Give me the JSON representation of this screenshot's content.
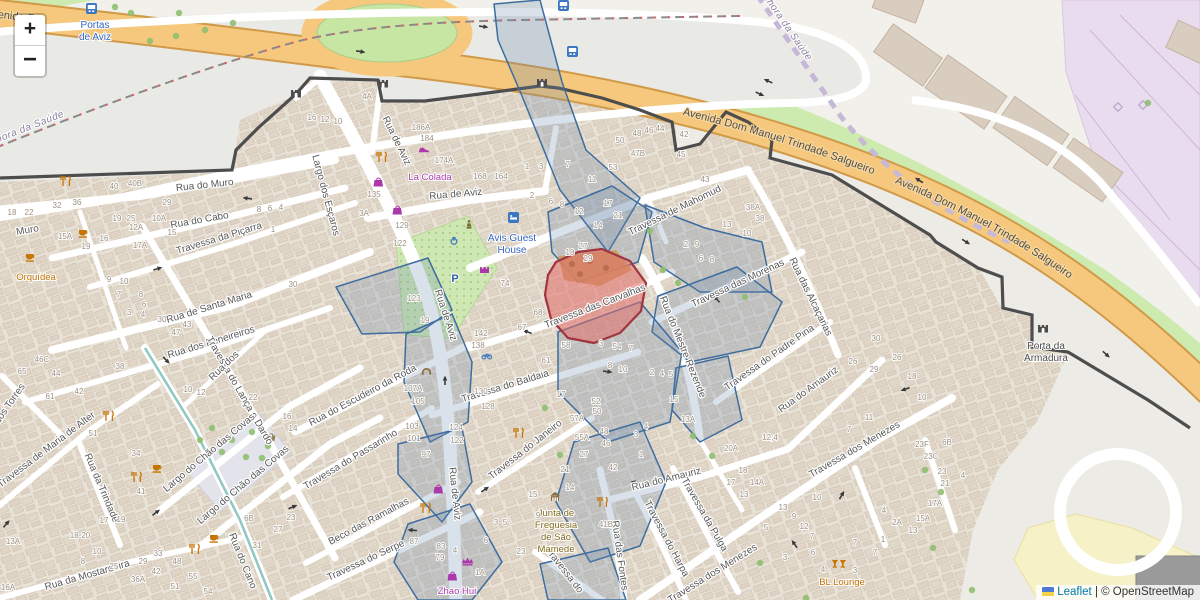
{
  "controls": {
    "zoom_in": "+",
    "zoom_out": "−"
  },
  "attribution": {
    "leaflet": "Leaflet",
    "separator": "|",
    "copyright": "© OpenStreetMap"
  },
  "avenue": {
    "name": "Avenida Dom Manuel Trindade Salgueiro"
  },
  "boundary": {
    "a": "Bacelo e Senhora da Saúde",
    "b": "Bacelo e Senhora da Saúde"
  },
  "fragments": {
    "avenida": "Avenida D"
  },
  "streets": [
    "Rua de Aviz",
    "Rua de Aviz",
    "Rua de Aviz",
    "Rua de Aviz",
    "Rua do Muro",
    "Muro",
    "Rua do Cabo",
    "Travessa da Piçarra",
    "Rua de Santa Maria",
    "Rua dos Peneireiros",
    "Largo dos Esçaros",
    "Travessa do Lança e Dardo",
    "Travessa do Baldaia",
    "Travessa do Janeiro",
    "Rua do Escudeiro da Roda",
    "Travessa do Passarinho",
    "Beco das Ramalhas",
    "Travessa do Serpe",
    "Rua da Trindade",
    "Travessa de Maria de Alter",
    "Rua dos Torres",
    "Largo do Chão das Covas",
    "Largo do Chão das Covas",
    "Rua do Cano",
    "Rua da Mostardeira",
    "Rua dos",
    "Rua do Amauriz",
    "Rua do Amauriz",
    "Travessa do Harpa",
    "Travessa da Pulga",
    "Travessa dos Menezes",
    "Travessa dos Menezes",
    "Travessa do Padre Pina",
    "Rua do Mestre Rezende",
    "Travessa das Morenas",
    "Travessa de Mahomud",
    "Rua das Alcaçarias",
    "Travessa das Carvalhas",
    "Rua das Fontes",
    "Travessa do"
  ],
  "places": {
    "portas": {
      "l1": "Portas",
      "l2": "de Aviz"
    },
    "la_colada": "La Colada",
    "avis": {
      "l1": "Avis Guest",
      "l2": "House"
    },
    "orquidea": "Orquídea",
    "junta": {
      "l1": "Junta de",
      "l2": "Freguesia",
      "l3": "de São",
      "l4": "Mamede"
    },
    "zhao": "Zhao Hui",
    "bl": "BL Lounge",
    "armadura": {
      "l1": "Porta da",
      "l2": "Armadura"
    },
    "parking": "P"
  },
  "nums": [
    "18",
    "22",
    "32",
    "36",
    "40",
    "40B",
    "29",
    "19",
    "25",
    "12A",
    "10A",
    "15",
    "17A",
    "15A",
    "19",
    "16",
    "9",
    "10",
    "7",
    "8",
    "6",
    "4",
    "3",
    "30",
    "43",
    "47",
    "8",
    "6",
    "4",
    "1",
    "30",
    "46C",
    "65",
    "44",
    "61",
    "42",
    "38",
    "51",
    "34",
    "41",
    "17",
    "19",
    "18-20",
    "13A",
    "10",
    "8",
    "25",
    "36A",
    "29",
    "33",
    "48",
    "42",
    "55",
    "51",
    "54",
    "6B",
    "23",
    "27",
    "31",
    "16",
    "14",
    "22",
    "10",
    "12",
    "16A",
    "4A",
    "16",
    "12",
    "10",
    "186A",
    "184",
    "174A",
    "168",
    "164",
    "135",
    "3A",
    "129",
    "122",
    "123",
    "19",
    "142",
    "138",
    "107A",
    "105",
    "103",
    "101",
    "97",
    "130",
    "128",
    "124",
    "122",
    "87",
    "83",
    "79",
    "1",
    "3",
    "7",
    "2",
    "6",
    "8",
    "12",
    "14",
    "17",
    "21",
    "11",
    "18",
    "27",
    "29",
    "74",
    "68",
    "67",
    "58",
    "61",
    "54",
    "7",
    "8",
    "10",
    "17",
    "3",
    "2",
    "4",
    "5",
    "50",
    "48",
    "46",
    "44",
    "42",
    "47B",
    "45",
    "43",
    "53",
    "38A",
    "38",
    "13",
    "10",
    "2",
    "9",
    "6",
    "8",
    "52",
    "50",
    "57A",
    "55A",
    "48",
    "46",
    "27",
    "42",
    "21",
    "14",
    "15",
    "41B",
    "15",
    "13A",
    "4",
    "3",
    "1",
    "23",
    "6",
    "3",
    "5",
    "4",
    "1A",
    "9",
    "30",
    "26",
    "29",
    "26",
    "18",
    "10",
    "11",
    "7",
    "12;4",
    "20A",
    "18",
    "17",
    "14A",
    "13",
    "13",
    "9",
    "12",
    "7",
    "5",
    "23F",
    "6B",
    "23C",
    "23",
    "21",
    "4",
    "17A",
    "15A",
    "13",
    "2A",
    "4",
    "10",
    "7",
    "3",
    "6",
    "4",
    "3",
    "7",
    "1"
  ],
  "icons": {
    "bus-stop": "blue square with white bus",
    "restaurant": "orange fork and knife",
    "cafe": "orange cup",
    "bar": "orange cocktail glasses",
    "shop": "purple bag",
    "jewelry": "purple crown",
    "shoe-shop": "purple shoe",
    "monument": "purple fort",
    "convenience": "khaki basket",
    "telephone": "ochre handset",
    "hotel": "blue lodging square",
    "parking": "blue letter P",
    "fountain": "blue fountain",
    "bicycle-parking": "blue bicycle",
    "town-hall": "brown civic building",
    "city-gate": "dark castle gate",
    "statue": "khaki statue",
    "tree": "green circle"
  },
  "colors": {
    "overlay_stroke": "#3e6da0",
    "overlay_fill": "rgba(105,135,170,0.25)",
    "selection_stroke": "#a0353f",
    "selection_fill": "rgba(226,110,105,0.55)",
    "avenue_fill": "#f6c87d",
    "avenue_casing": "#d09a48",
    "wall": "#4d4d4d",
    "aqueduct": "#8fc8c2",
    "grass": "#cdeaaf",
    "retail_zone": "#eadcef",
    "link_blue": "#0078A8"
  }
}
